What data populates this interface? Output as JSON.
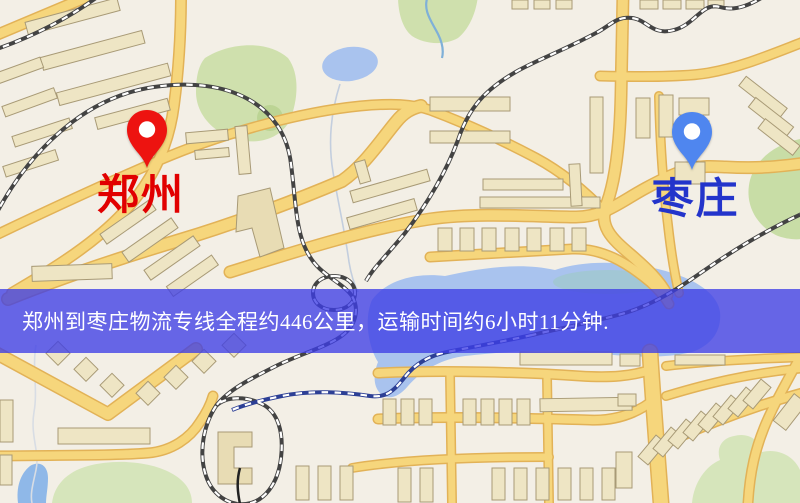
{
  "banner": {
    "text": "郑州到枣庄物流专线全程约446公里，运输时间约6小时11分钟.",
    "background": "rgba(62,62,230,0.78)",
    "text_color": "#ffffff",
    "route": {
      "origin": "郑州",
      "destination": "枣庄",
      "distance": "446公里",
      "duration": "6小时11分钟"
    }
  },
  "markers": {
    "origin": {
      "label": "郑州",
      "pin_color": "#ed1310",
      "label_color": "#e10000"
    },
    "destination": {
      "label": "枣庄",
      "pin_color": "#4f86ef",
      "label_color": "#2334cb"
    }
  },
  "map_colors": {
    "background": "#f3efe6",
    "road_fill": "#f6d67c",
    "road_casing": "#e2b257",
    "water": "#a9c3ee",
    "green": "#cfe0ad",
    "railway": "#434343",
    "railway_on_water": "#2c3f95",
    "building": "#eee5c4"
  }
}
